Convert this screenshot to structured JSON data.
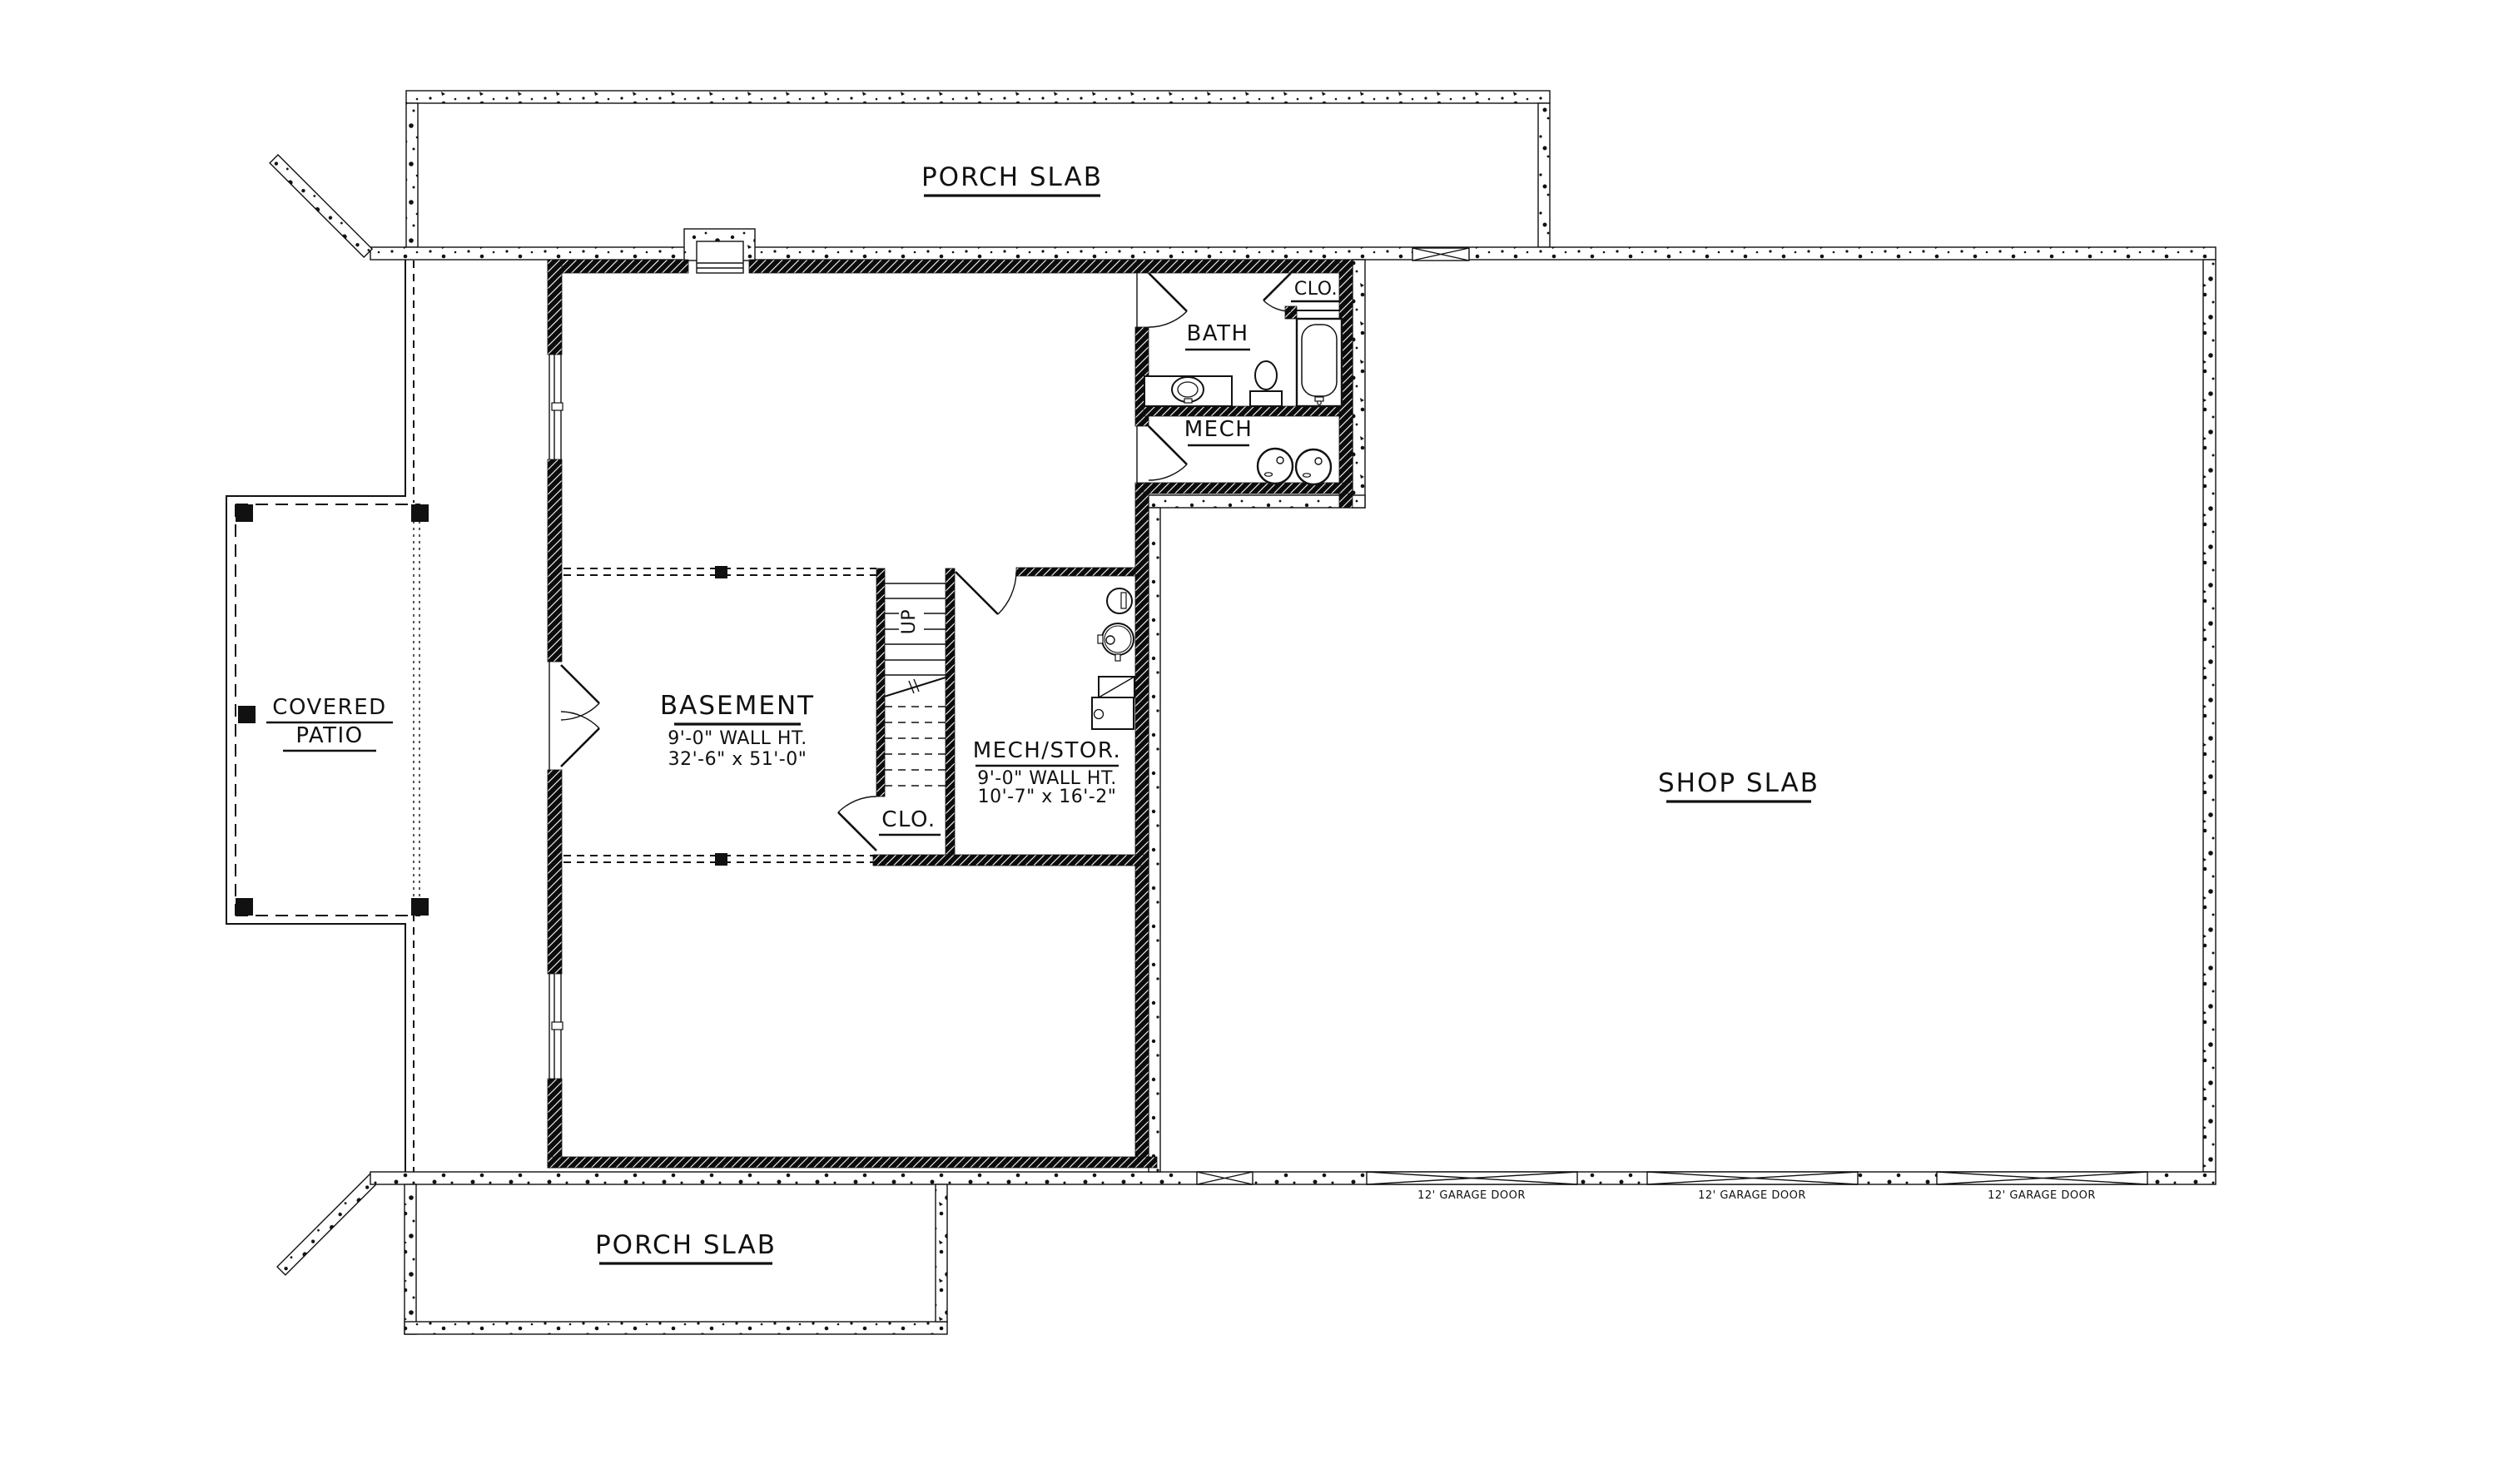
{
  "page": {
    "title": "Basement / Shop Slab Floor Plan",
    "background_color": "#ffffff",
    "line_color": "#111111"
  },
  "labels": {
    "porch_slab_top": "PORCH SLAB",
    "porch_slab_bottom": "PORCH SLAB",
    "shop_slab": "SHOP SLAB",
    "covered_patio_line1": "COVERED",
    "covered_patio_line2": "PATIO",
    "bath": "BATH",
    "bath_closet": "CLO.",
    "mech": "MECH",
    "stairs_up": "UP",
    "stairs_closet": "CLO.",
    "garage_door_1": "12' GARAGE DOOR",
    "garage_door_2": "12' GARAGE DOOR",
    "garage_door_3": "12' GARAGE DOOR"
  },
  "rooms": {
    "basement": {
      "name": "BASEMENT",
      "wall_height": "9'-0\" WALL HT.",
      "dimensions": "32'-6\" x 51'-0\""
    },
    "mech_stor": {
      "name": "MECH/STOR.",
      "wall_height": "9'-0\" WALL HT.",
      "dimensions": "10'-7\" x 16'-2\""
    }
  }
}
